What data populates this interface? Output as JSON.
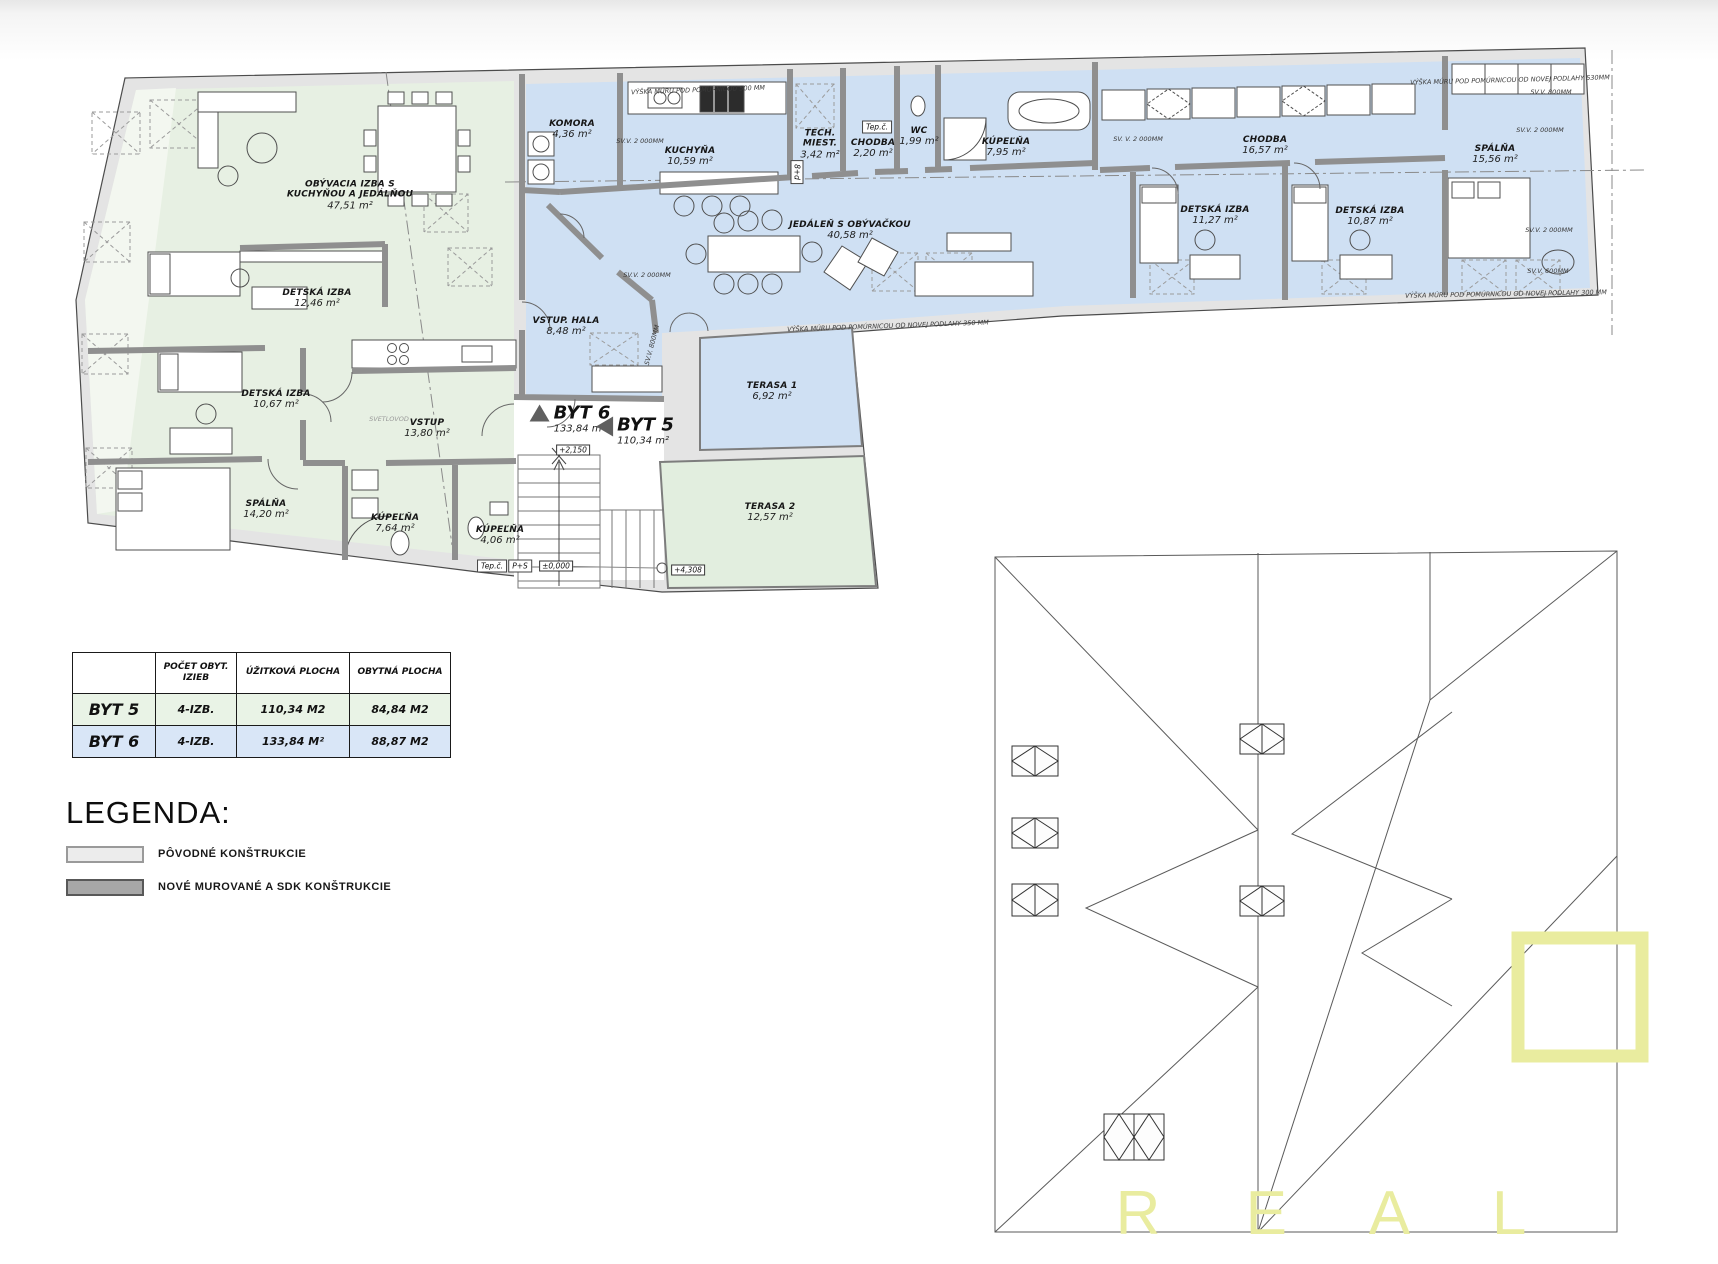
{
  "units": {
    "byt6": {
      "label": "BYT 6",
      "area": "133,84 m²"
    },
    "byt5": {
      "label": "BYT 5",
      "area": "110,34 m²"
    }
  },
  "rooms": {
    "b5": [
      {
        "name": "OBÝVACIA IZBA S KUCHYŇOU A JEDÁLŇOU",
        "area": "47,51 m²"
      },
      {
        "name": "DETSKÁ IZBA",
        "area": "12,46 m²"
      },
      {
        "name": "DETSKÁ IZBA",
        "area": "10,67 m²"
      },
      {
        "name": "VSTUP",
        "area": "13,80 m²"
      },
      {
        "name": "SPÁLŇA",
        "area": "14,20 m²"
      },
      {
        "name": "KÚPEĽŇA",
        "area": "7,64 m²"
      },
      {
        "name": "KÚPEĽŇA",
        "area": "4,06 m²"
      }
    ],
    "b6": [
      {
        "name": "KOMORA",
        "area": "4,36 m²"
      },
      {
        "name": "KUCHYŇA",
        "area": "10,59 m²"
      },
      {
        "name": "TECH. MIEST.",
        "area": "3,42 m²"
      },
      {
        "name": "CHODBA",
        "area": "2,20 m²"
      },
      {
        "name": "WC",
        "area": "1,99 m²"
      },
      {
        "name": "KÚPEĽŇA",
        "area": "7,95 m²"
      },
      {
        "name": "JEDÁLEŇ S OBÝVAČKOU",
        "area": "40,58 m²"
      },
      {
        "name": "CHODBA",
        "area": "16,57 m²"
      },
      {
        "name": "DETSKÁ IZBA",
        "area": "11,27 m²"
      },
      {
        "name": "DETSKÁ IZBA",
        "area": "10,87 m²"
      },
      {
        "name": "SPÁLŇA",
        "area": "15,56 m²"
      },
      {
        "name": "VSTUP. HALA",
        "area": "8,48 m²"
      }
    ],
    "terraces": [
      {
        "name": "TERASA 1",
        "area": "6,92 m²"
      },
      {
        "name": "TERASA 2",
        "area": "12,57 m²"
      }
    ]
  },
  "annotations": [
    {
      "text": "VÝŠKA MÚRU POD POMÚRNICOU 500 MM"
    },
    {
      "text": "SV.V. 2 000MM"
    },
    {
      "text": "SV.V. 2 000MM"
    },
    {
      "text": "SVETLOVOD"
    },
    {
      "text": "VÝŠKA MÚRU POD POMÚRNICOU OD NOVEJ PODLAHY 350 MM"
    },
    {
      "text": "SV. V. 2 000MM"
    },
    {
      "text": "VÝŠKA MÚRU POD POMÚRNICOU OD NOVEJ PODLAHY 530MM"
    },
    {
      "text": "SV.V. 800MM"
    },
    {
      "text": "SV.V. 2 000MM"
    },
    {
      "text": "SV.V. 2 000MM"
    },
    {
      "text": "SV.V. 600MM"
    },
    {
      "text": "VÝŠKA MÚRU POD POMÚRNICOU OD NOVEJ PODLAHY 300 MM"
    },
    {
      "text": "SV.V. 800MM"
    }
  ],
  "levels": [
    {
      "text": "+2,150"
    },
    {
      "text": "±0,000"
    },
    {
      "text": "+4,308"
    }
  ],
  "boxes": [
    {
      "text": "Tep.č."
    },
    {
      "text": "8+d"
    },
    {
      "text": "Tep.č."
    },
    {
      "text": "P+S"
    }
  ],
  "table": {
    "headers": [
      "",
      "POČET OBYT. IZIEB",
      "ÚŽITKOVÁ PLOCHA",
      "OBYTNÁ PLOCHA"
    ],
    "rows": [
      {
        "unit": "BYT 5",
        "izby": "4-IZB.",
        "uzitkova": "110,34 M2",
        "obytna": "84,84 M2"
      },
      {
        "unit": "BYT 6",
        "izby": "4-IZB.",
        "uzitkova": "133,84 M²",
        "obytna": "88,87 M2"
      }
    ]
  },
  "legend": {
    "title": "LEGENDA:",
    "items": [
      {
        "label": "PÔVODNÉ KONŠTRUKCIE",
        "swatch": "#ececec"
      },
      {
        "label": "NOVÉ MUROVANÉ A SDK KONŠTRUKCIE",
        "swatch": "#a7a7a7"
      }
    ]
  },
  "watermark": {
    "text": "R E A L"
  },
  "colors": {
    "byt5_fill": "#e7f0e3",
    "byt6_fill": "#cfe0f3",
    "terasa2_fill": "#e2eedf",
    "wall_new": "#8f8f8f",
    "wall_old": "#e4e4e4",
    "watermark_yellow": "#e9ec9f"
  }
}
